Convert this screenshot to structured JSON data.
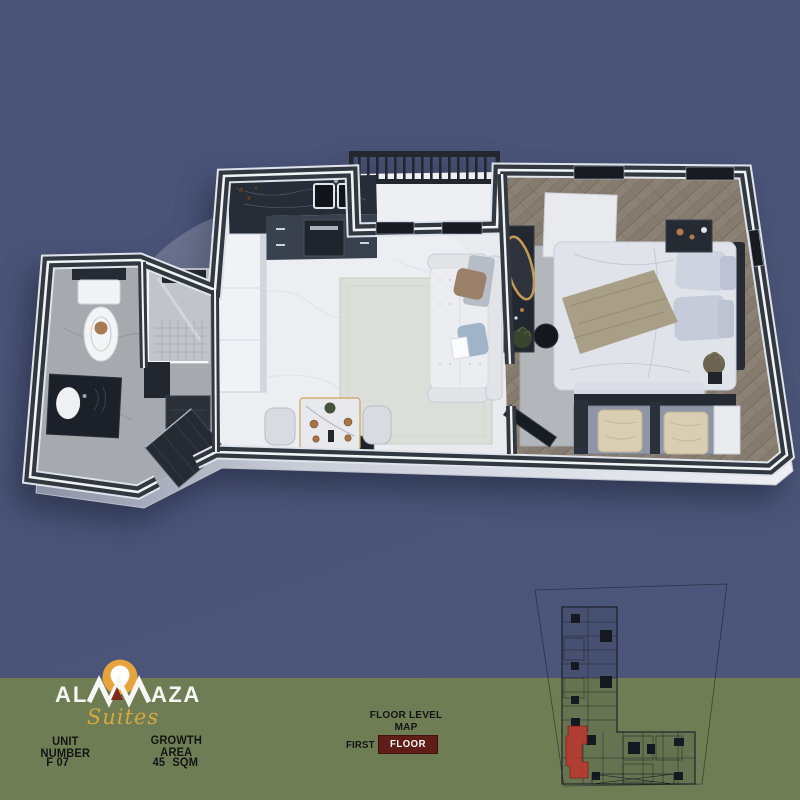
{
  "colors": {
    "background_blue": "#4a5477",
    "band_green": "#6f7d55",
    "box_maroon": "#5e1d17",
    "logo_orange": "#e7a33c",
    "logo_gold": "#d8a83e",
    "logo_red": "#7d2b1f",
    "map_highlight": "#b73a31",
    "text_dark": "#141414",
    "text_light": "#f8f8f6"
  },
  "logo": {
    "brand": "ALMAZA",
    "brand_left": "AL",
    "brand_right": "AZA",
    "suffix": "Suites",
    "icon": "sun-location-pin-icon"
  },
  "unit": {
    "label": "UNIT NUMBER",
    "value": "F 07"
  },
  "area": {
    "label": "GROWTH AREA",
    "value": "45 SQM"
  },
  "floor_map": {
    "title": "FLOOR LEVEL MAP",
    "level_label": "FIRST",
    "level_value": "FLOOR",
    "highlighted_unit": "F 07"
  }
}
